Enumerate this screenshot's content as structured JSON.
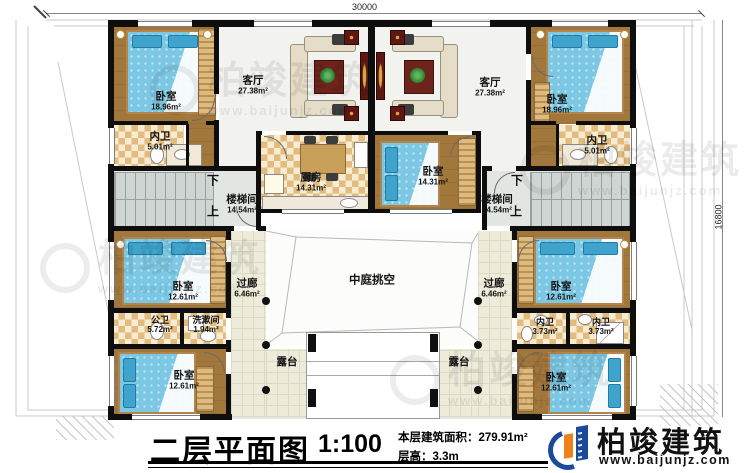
{
  "dimensions": {
    "top": "30000",
    "right": "16800"
  },
  "stair": {
    "name": "楼梯间",
    "area": "14.54m²",
    "down": "下",
    "up": "上"
  },
  "rooms": {
    "bedroom_tl": {
      "name": "卧室",
      "area": "18.96m²"
    },
    "bedroom_tr": {
      "name": "卧室",
      "area": "18.96m²"
    },
    "living_left": {
      "name": "客厅",
      "area": "27.38m²"
    },
    "living_right": {
      "name": "客厅",
      "area": "27.38m²"
    },
    "neiwei_tl": {
      "name": "内卫",
      "area": "5.01m²"
    },
    "neiwei_tr": {
      "name": "内卫",
      "area": "5.01m²"
    },
    "kitchen": {
      "name": "厨房",
      "area": "14.31m²"
    },
    "bedroom_mc": {
      "name": "卧室",
      "area": "14.31m²"
    },
    "bedroom_ml": {
      "name": "卧室",
      "area": "12.61m²"
    },
    "bedroom_mr": {
      "name": "卧室",
      "area": "12.61m²"
    },
    "bedroom_bl": {
      "name": "卧室",
      "area": "12.61m²"
    },
    "bedroom_br": {
      "name": "卧室",
      "area": "12.61m²"
    },
    "gongwei": {
      "name": "公卫",
      "area": "5.72m²"
    },
    "xishujian": {
      "name": "洗漱间",
      "area": "1.94m²"
    },
    "neiwei_br1": {
      "name": "内卫",
      "area": "3.73m²"
    },
    "neiwei_br2": {
      "name": "内卫",
      "area": "3.73m²"
    },
    "corridor_left": {
      "name": "过廊",
      "area": "6.46m²"
    },
    "corridor_right": {
      "name": "过廊",
      "area": "6.46m²"
    },
    "atrium": {
      "name": "中庭挑空"
    },
    "terrace_left": {
      "name": "露台"
    },
    "terrace_right": {
      "name": "露台"
    }
  },
  "titleblock": {
    "title": "二层平面图",
    "scale": "1:100",
    "area_label": "本层建筑面积：279.91m²",
    "floor_height": "层高：3.3m"
  },
  "logo": {
    "name": "柏竣建筑",
    "url": "www.baijunjz.com"
  },
  "watermark": {
    "text": "柏竣建筑",
    "url": "www.baijunjz.com"
  },
  "colors": {
    "wall": "#0e0e0e",
    "wood_floor": "#a2773c",
    "tile_light": "#f7ecd2",
    "tile_dark": "#e2bb7e",
    "corridor_floor": "#edebd9",
    "bed": "#7cc8e4",
    "logo_blue": "#1b4a9b",
    "logo_orange": "#f07f1e"
  }
}
